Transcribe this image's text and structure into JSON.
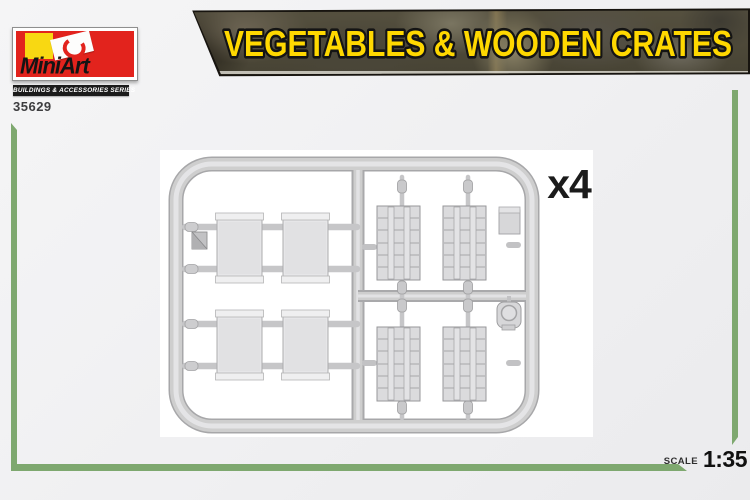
{
  "page": {
    "background": "#f0f0f1"
  },
  "brand": {
    "name": "MiniArt",
    "series_label": "BUILDINGS & ACCESSORIES SERIES",
    "product_code": "35629",
    "logo_red": "#e2231d",
    "logo_yellow": "#f8d812"
  },
  "banner": {
    "title": "VEGETABLES & WOODEN CRATES",
    "title_color": "#ffd800",
    "outline_color": "#141414"
  },
  "sprue": {
    "quantity_label": "x4",
    "plastic_color": "#d6d6d8",
    "photo_background": "#ffffff",
    "plain_panel_count": 4,
    "slatted_panel_count": 4
  },
  "footer": {
    "scale_label": "SCALE",
    "scale_value": "1:35",
    "accent_color": "#7ea86f"
  }
}
